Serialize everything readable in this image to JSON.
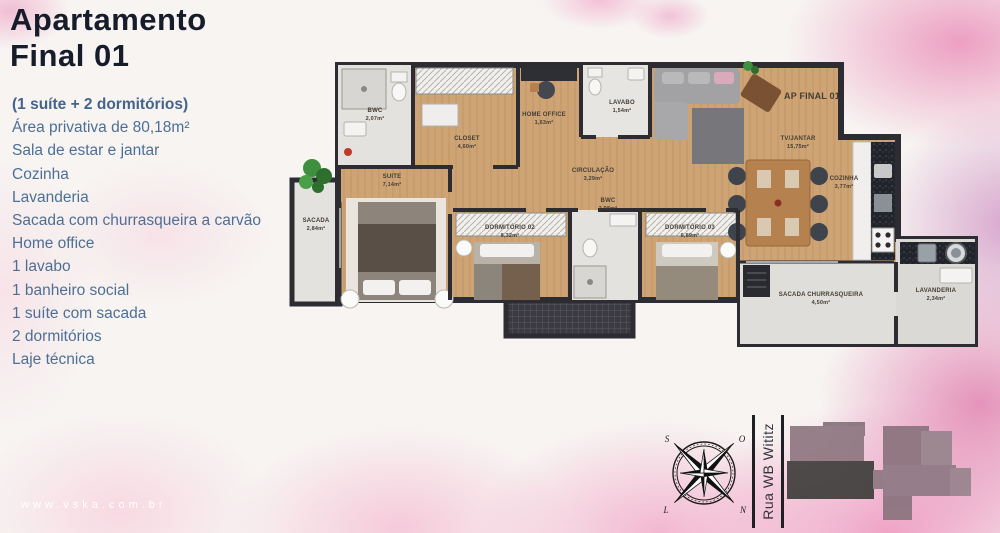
{
  "page": {
    "title_line1": "Apartamento",
    "title_line2": "Final 01",
    "website": "www.vska.com.br"
  },
  "features": {
    "heading": "(1 suíte + 2 dormitórios)",
    "items": [
      "Área privativa de 80,18m²",
      "Sala de estar e jantar",
      "Cozinha",
      "Lavanderia",
      "Sacada com churrasqueira a carvão",
      "Home office",
      "1 lavabo",
      "1 banheiro social",
      "1 suíte com sacada",
      "2 dormitórios",
      "Laje técnica"
    ]
  },
  "floor_plan": {
    "unit_label": "AP FINAL 01",
    "rooms": [
      {
        "name": "BWC",
        "area": "2,07m²"
      },
      {
        "name": "SACADA",
        "area": "2,84m²"
      },
      {
        "name": "SUITE",
        "area": "7,14m²"
      },
      {
        "name": "CLOSET",
        "area": "4,60m²"
      },
      {
        "name": "HOME OFFICE",
        "area": "1,63m²"
      },
      {
        "name": "LAVABO",
        "area": "1,54m²"
      },
      {
        "name": "CIRCULAÇÃO",
        "area": "3,29m²"
      },
      {
        "name": "DORMITÓRIO 02",
        "area": "8,32m²"
      },
      {
        "name": "BWC",
        "area": "2,98m²"
      },
      {
        "name": "DORMITÓRIO 03",
        "area": "6,89m²"
      },
      {
        "name": "TV/JANTAR",
        "area": "15,75m²"
      },
      {
        "name": "COZINHA",
        "area": "3,77m²"
      },
      {
        "name": "SACADA CHURRASQUEIRA",
        "area": "4,50m²"
      },
      {
        "name": "LAVANDERIA",
        "area": "2,34m²"
      }
    ]
  },
  "compass": {
    "north": "N",
    "south": "S",
    "east": "L",
    "west": "O"
  },
  "street": {
    "name": "Rua WB Wititz"
  },
  "colors": {
    "title": "#171c2b",
    "feature_text": "#4d6f96",
    "wall": "#2c2c32",
    "wood_floor": "#cea475",
    "tile_floor": "#e4e2de",
    "watercolor_pink": "#ee94be"
  }
}
